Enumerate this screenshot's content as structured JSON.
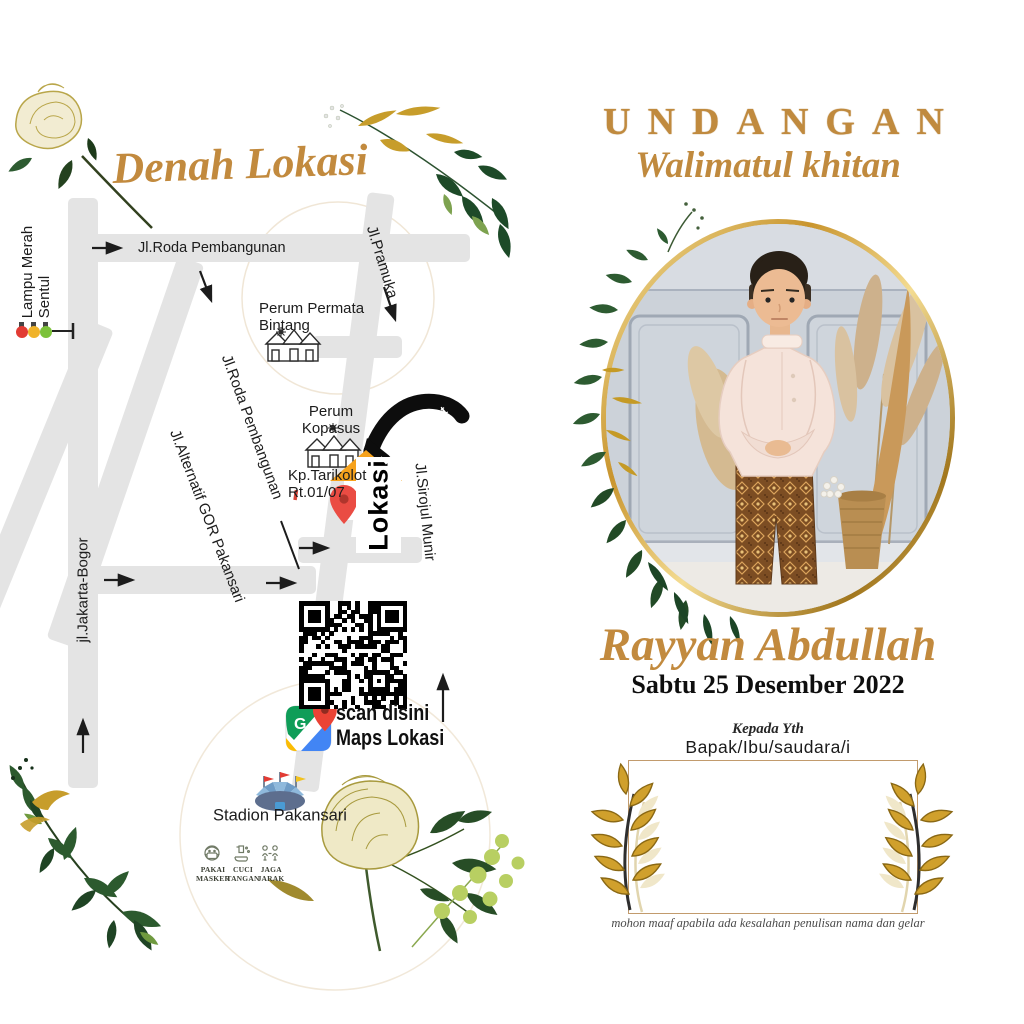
{
  "left": {
    "title": "Denah Lokasi",
    "streets": {
      "roda": "Jl.Roda Pembangunan",
      "pramuka": "Jl.Pramuka",
      "sirojul": "Jl.Sirojul Munir",
      "alternatif": "Jl.Alternatif GOR Pakansari",
      "jakarta": "jl.Jakarta-Bogor"
    },
    "places": {
      "lampu1": "Lampu Merah",
      "lampu2": "Sentul",
      "permata1": "Perum Permata",
      "permata2": "Bintang",
      "kopasus1": "Perum",
      "kopasus2": "Kopasus",
      "tarikolot1": "Kp.Tarikolot",
      "tarikolot2": "Rt.01/07",
      "stadion": "Stadion Pakansari"
    },
    "marker": {
      "lokasi": "Lokasi",
      "hajat": "Lokasi Hajat"
    },
    "qr": {
      "line1": "scan disini",
      "line2": "Maps Lokasi",
      "google_g": "G"
    },
    "health": [
      {
        "l1": "PAKAI",
        "l2": "MASKER"
      },
      {
        "l1": "CUCI",
        "l2": "TANGAN"
      },
      {
        "l1": "JAGA",
        "l2": "JARAK"
      }
    ]
  },
  "right": {
    "title": "UNDANGAN",
    "subtitle": "Walimatul khitan",
    "child_name": "Rayyan Abdullah",
    "event_date": "Sabtu 25 Desember 2022",
    "kepada": "Kepada Yth",
    "recipient": "Bapak/Ibu/saudara/i",
    "note": "mohon maaf apabila ada kesalahan penulisan nama dan gelar"
  },
  "colors": {
    "gold_text": "#c28a3e",
    "road_gray": "#e4e4e4",
    "marker_roof_orange": "#f6a21c",
    "pin_red": "#ea4c43",
    "traffic_red": "#e23b34",
    "traffic_yellow": "#f0b32a",
    "traffic_green": "#7cc23a",
    "box_border_tan": "#c29b6d"
  }
}
